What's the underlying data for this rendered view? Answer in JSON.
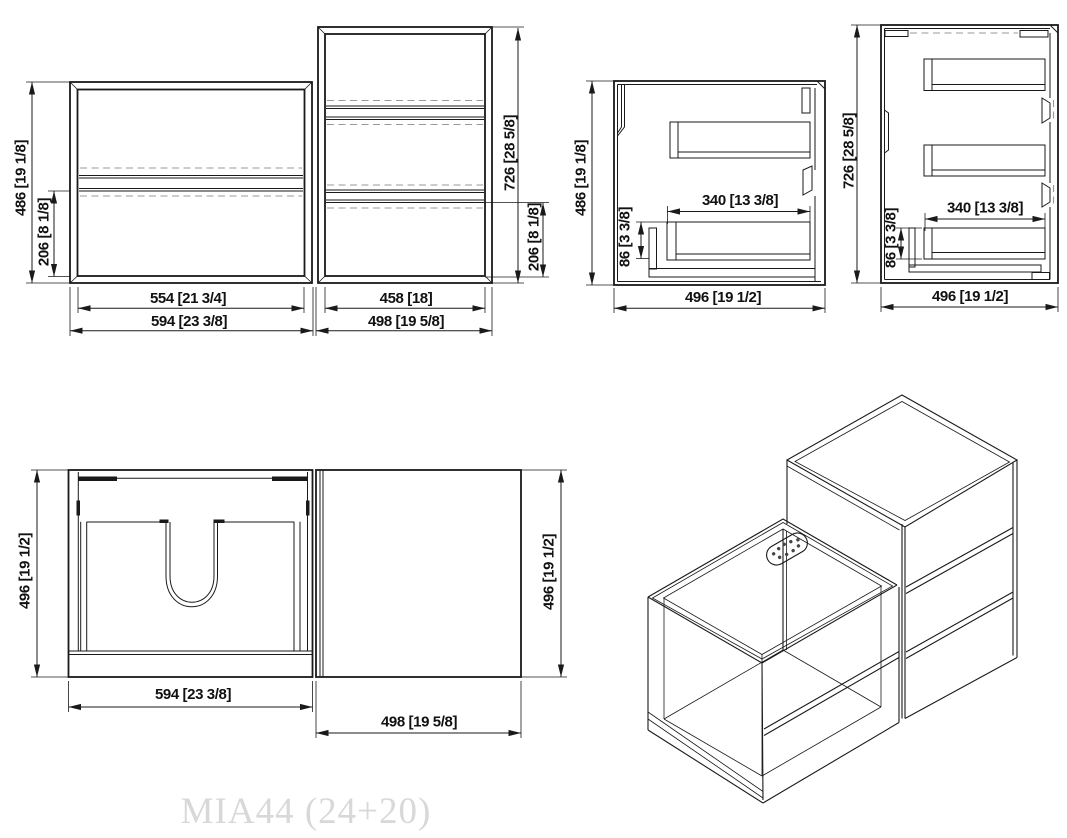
{
  "watermark": "MIA44 (24+20)",
  "colors": {
    "line": "#1a1a1a",
    "hidden_line": "#999999",
    "watermark": "#d8d8d8",
    "background": "#ffffff"
  },
  "views": {
    "front": {
      "vanity": {
        "height": "486 [19 1/8]",
        "drawer_height": "206 [8 1/8]",
        "inner_width": "554 [21 3/4]",
        "outer_width": "594 [23 3/8]"
      },
      "tall_cabinet": {
        "height": "726 [28 5/8]",
        "drawer_height": "206 [8 1/8]",
        "inner_width": "458 [18]",
        "outer_width": "498 [19 5/8]"
      }
    },
    "side_vanity": {
      "height": "486 [19 1/8]",
      "depth": "496 [19 1/2]",
      "drawer_depth": "340 [13 3/8]",
      "drawer_height": "86 [3 3/8]"
    },
    "side_tall": {
      "height": "726 [28 5/8]",
      "depth": "496 [19 1/2]",
      "drawer_depth": "340 [13 3/8]",
      "drawer_height": "86 [3 3/8]"
    },
    "top": {
      "vanity_depth": "496 [19 1/2]",
      "vanity_width": "594 [23 3/8]",
      "side_depth": "496 [19 1/2]",
      "side_width": "498 [19 5/8]"
    }
  }
}
